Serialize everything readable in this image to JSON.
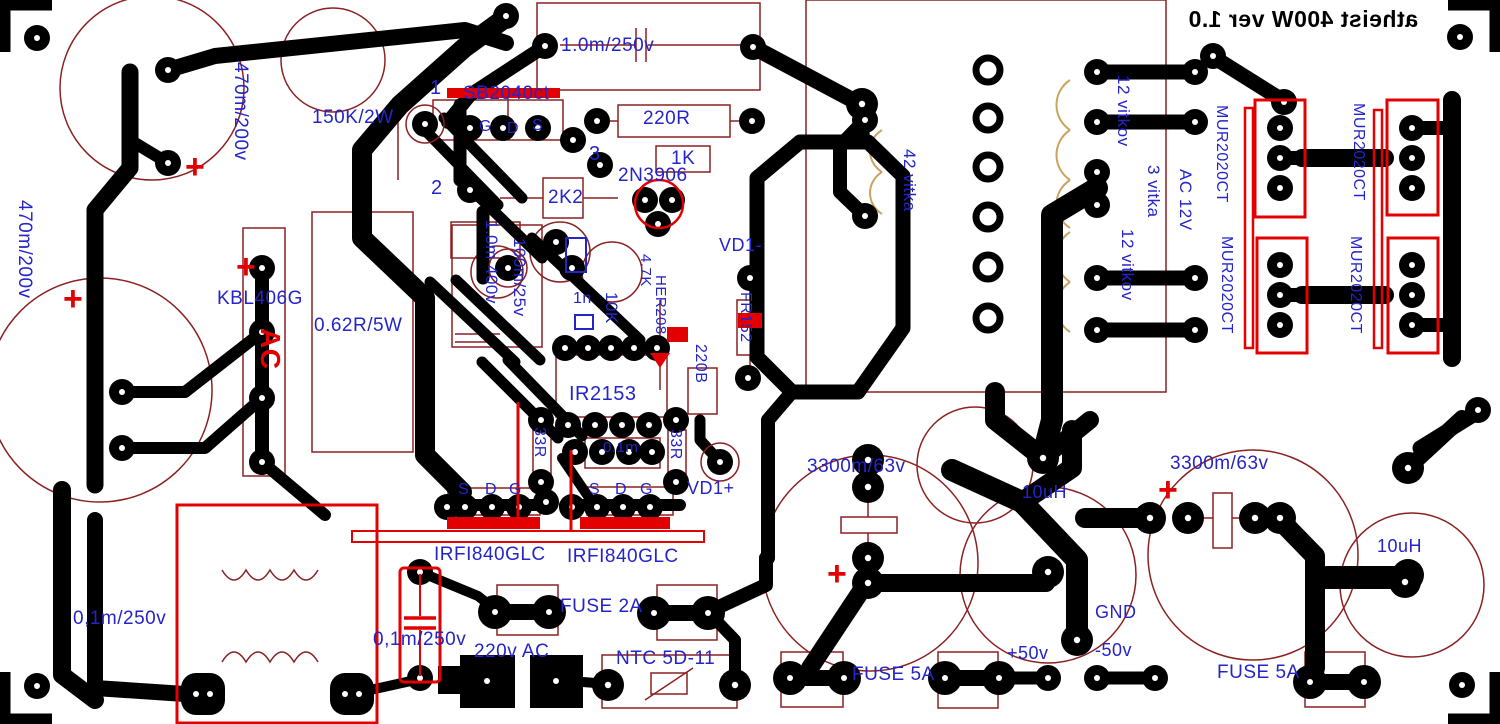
{
  "board": {
    "title": "atheist 400W ver 1.0",
    "title_mirrored": true,
    "colors": {
      "copper": "#000000",
      "silkscreen": "#8b2121",
      "highlight": "#e30000",
      "label": "#2424c8",
      "coil": "#c9a35f",
      "background": "#ffffff"
    }
  },
  "symbols": {
    "plus": "+"
  },
  "labels": [
    {
      "t": "1.0m/250v",
      "x": 561,
      "y": 36,
      "s": 19
    },
    {
      "t": "470m/200v",
      "x": 228,
      "y": 62,
      "s": 19,
      "r": 1
    },
    {
      "t": "470m/200v",
      "x": 12,
      "y": 200,
      "s": 19,
      "r": 1
    },
    {
      "t": "150K/2W",
      "x": 312,
      "y": 108,
      "s": 19
    },
    {
      "t": "1",
      "x": 430,
      "y": 78,
      "s": 20
    },
    {
      "t": "SB2040ct",
      "x": 463,
      "y": 84,
      "s": 19
    },
    {
      "t": "G",
      "x": 479,
      "y": 119,
      "s": 16
    },
    {
      "t": "D",
      "x": 507,
      "y": 121,
      "s": 16
    },
    {
      "t": "S",
      "x": 532,
      "y": 118,
      "s": 16
    },
    {
      "t": "2",
      "x": 431,
      "y": 178,
      "s": 20
    },
    {
      "t": "3",
      "x": 589,
      "y": 144,
      "s": 20
    },
    {
      "t": "220R",
      "x": 643,
      "y": 109,
      "s": 19
    },
    {
      "t": "1K",
      "x": 671,
      "y": 149,
      "s": 19
    },
    {
      "t": "2N3906",
      "x": 618,
      "y": 166,
      "s": 19
    },
    {
      "t": "2K2",
      "x": 548,
      "y": 188,
      "s": 19
    },
    {
      "t": "VD1-",
      "x": 719,
      "y": 236,
      "s": 18
    },
    {
      "t": "1.0m 400v",
      "x": 480,
      "y": 220,
      "s": 17,
      "r": 1
    },
    {
      "t": "100m/25v",
      "x": 508,
      "y": 238,
      "s": 17,
      "r": 1
    },
    {
      "t": "1n",
      "x": 573,
      "y": 291,
      "s": 16
    },
    {
      "t": "10K",
      "x": 600,
      "y": 292,
      "s": 17,
      "r": 1
    },
    {
      "t": "4.7K",
      "x": 636,
      "y": 254,
      "s": 15,
      "r": 1
    },
    {
      "t": "HER208",
      "x": 651,
      "y": 275,
      "s": 15,
      "r": 1
    },
    {
      "t": "FR152",
      "x": 735,
      "y": 292,
      "s": 16,
      "r": 1
    },
    {
      "t": "220B",
      "x": 690,
      "y": 344,
      "s": 16,
      "r": 1
    },
    {
      "t": "IR2153",
      "x": 569,
      "y": 384,
      "s": 20
    },
    {
      "t": "KBL406G",
      "x": 217,
      "y": 289,
      "s": 19
    },
    {
      "t": "0.62R/5W",
      "x": 314,
      "y": 316,
      "s": 19
    },
    {
      "t": "AC",
      "x": 252,
      "y": 328,
      "s": 28,
      "r": 1,
      "c": "red"
    },
    {
      "t": "33R",
      "x": 529,
      "y": 427,
      "s": 16,
      "r": 1
    },
    {
      "t": "0.1m",
      "x": 603,
      "y": 440,
      "s": 15
    },
    {
      "t": "33R",
      "x": 665,
      "y": 429,
      "s": 16,
      "r": 1
    },
    {
      "t": "VD1+",
      "x": 687,
      "y": 479,
      "s": 18
    },
    {
      "t": "S",
      "x": 458,
      "y": 482,
      "s": 16
    },
    {
      "t": "D",
      "x": 485,
      "y": 482,
      "s": 16
    },
    {
      "t": "G",
      "x": 509,
      "y": 482,
      "s": 16
    },
    {
      "t": "S",
      "x": 589,
      "y": 482,
      "s": 16
    },
    {
      "t": "D",
      "x": 615,
      "y": 482,
      "s": 16
    },
    {
      "t": "G",
      "x": 640,
      "y": 482,
      "s": 16
    },
    {
      "t": "IRFI840GLC",
      "x": 434,
      "y": 545,
      "s": 19
    },
    {
      "t": "IRFI840GLC",
      "x": 567,
      "y": 547,
      "s": 19
    },
    {
      "t": "FUSE 2A",
      "x": 560,
      "y": 597,
      "s": 19
    },
    {
      "t": "0,1m/250v",
      "x": 73,
      "y": 609,
      "s": 19
    },
    {
      "t": "0,1m/250v",
      "x": 373,
      "y": 630,
      "s": 19
    },
    {
      "t": "220v AC",
      "x": 474,
      "y": 642,
      "s": 19
    },
    {
      "t": "NTC 5D-11",
      "x": 616,
      "y": 649,
      "s": 19
    },
    {
      "t": "42 vitka",
      "x": 898,
      "y": 149,
      "s": 17,
      "r": 1
    },
    {
      "t": "12 vitkov",
      "x": 1112,
      "y": 75,
      "s": 17,
      "r": 1
    },
    {
      "t": "3 vitka",
      "x": 1142,
      "y": 165,
      "s": 17,
      "r": 1
    },
    {
      "t": "AC 12V",
      "x": 1174,
      "y": 169,
      "s": 17,
      "r": 1
    },
    {
      "t": "12 vitkov",
      "x": 1116,
      "y": 229,
      "s": 17,
      "r": 1
    },
    {
      "t": "MUR2020CT",
      "x": 1211,
      "y": 105,
      "s": 16,
      "r": 1
    },
    {
      "t": "MUR2020CT",
      "x": 1216,
      "y": 236,
      "s": 16,
      "r": 1
    },
    {
      "t": "MUR2020CT",
      "x": 1348,
      "y": 103,
      "s": 16,
      "r": 1
    },
    {
      "t": "MUR2020CT",
      "x": 1345,
      "y": 236,
      "s": 16,
      "r": 1
    },
    {
      "t": "3300m/63v",
      "x": 807,
      "y": 457,
      "s": 19
    },
    {
      "t": "10uH",
      "x": 1022,
      "y": 483,
      "s": 18
    },
    {
      "t": "GND",
      "x": 1095,
      "y": 603,
      "s": 18
    },
    {
      "t": "+50v",
      "x": 1007,
      "y": 644,
      "s": 18
    },
    {
      "t": "-50v",
      "x": 1095,
      "y": 641,
      "s": 18
    },
    {
      "t": "FUSE 5A",
      "x": 852,
      "y": 665,
      "s": 19
    },
    {
      "t": "3300m/63v",
      "x": 1170,
      "y": 454,
      "s": 19
    },
    {
      "t": "10uH",
      "x": 1377,
      "y": 537,
      "s": 18
    },
    {
      "t": "FUSE 5A",
      "x": 1217,
      "y": 663,
      "s": 19
    }
  ],
  "plus_marks": [
    {
      "x": 185,
      "y": 150
    },
    {
      "x": 63,
      "y": 282
    },
    {
      "x": 236,
      "y": 250
    },
    {
      "x": 827,
      "y": 557
    },
    {
      "x": 1158,
      "y": 473
    }
  ]
}
